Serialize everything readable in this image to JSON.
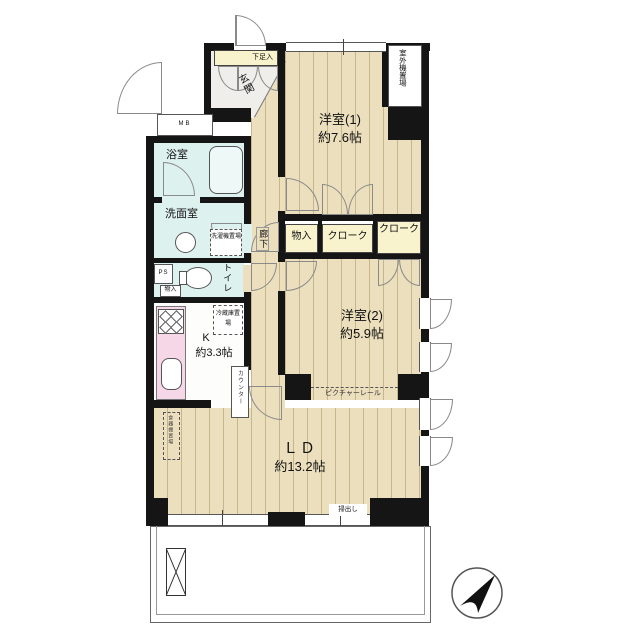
{
  "plan": {
    "rooms": {
      "western1": {
        "name": "洋室(1)",
        "size": "約7.6帖"
      },
      "western2": {
        "name": "洋室(2)",
        "size": "約5.9帖"
      },
      "living_dining": {
        "name": "ＬＤ",
        "size": "約13.2帖"
      },
      "kitchen": {
        "name": "K",
        "size": "約3.3帖"
      },
      "bathroom": {
        "name": "浴室"
      },
      "washroom": {
        "name": "洗面室"
      },
      "toilet": {
        "name": "トイレ"
      },
      "entrance": {
        "name": "玄関"
      },
      "hallway": {
        "name": "廊下"
      }
    },
    "storage": {
      "shoe_cabinet": "下足入",
      "mono_iri_hall": "物入",
      "cloak_1": "クローク",
      "cloak_2": "クローク",
      "mono_iri_small": "物入"
    },
    "annotations": {
      "outdoor_unit": "室外機置場",
      "meter_box": "MB",
      "pipe_space": "PS",
      "washing_machine": "洗濯機置場",
      "refrigerator": "冷蔵庫置場",
      "counter": "カウンター",
      "picture_rail": "ピクチャーレール",
      "sliding_window": "掃出し",
      "cupboard": "食器棚置場"
    },
    "colors": {
      "wall": "#151515",
      "wood_floor": "#ecdfbd",
      "wood_stripe": "#c5b68c",
      "wet_area": "#ddf1ee",
      "closet_cream": "#f8f3cd",
      "kitchen_counter_pink": "#f6d7e8",
      "entrance_gray": "#efeeea"
    }
  }
}
